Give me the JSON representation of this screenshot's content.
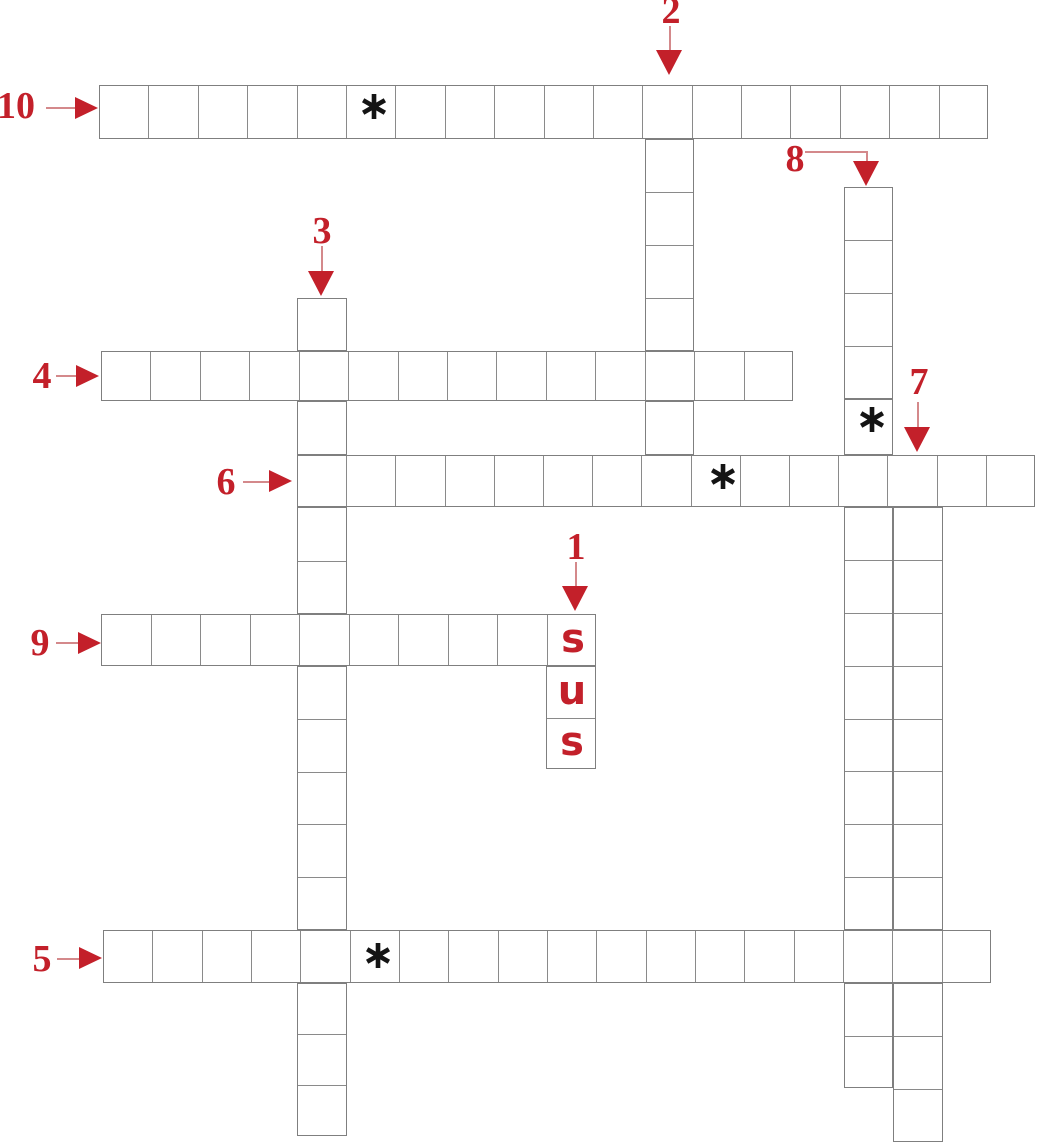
{
  "puzzle": {
    "type": "crossword",
    "colors": {
      "accent_red": "#c3202a",
      "arrow_line": "#d4898b",
      "grid_line": "#7f7f7f",
      "star_black": "#141414",
      "background": "#ffffff"
    },
    "star_char": "∗",
    "prefilled_letters": "sus",
    "clues": [
      {
        "number": "1",
        "direction": "down",
        "length": 3,
        "prefilled": "sus"
      },
      {
        "number": "2",
        "direction": "down",
        "length": 8
      },
      {
        "number": "3",
        "direction": "down",
        "length": 16
      },
      {
        "number": "4",
        "direction": "across",
        "length": 14
      },
      {
        "number": "5",
        "direction": "across",
        "length": 18,
        "star_cell": 6
      },
      {
        "number": "6",
        "direction": "across",
        "length": 15,
        "star_cell": 9
      },
      {
        "number": "7",
        "direction": "down",
        "length": 13
      },
      {
        "number": "8",
        "direction": "down",
        "length": 17,
        "star_cell": 5
      },
      {
        "number": "9",
        "direction": "across",
        "length": 10
      },
      {
        "number": "10",
        "direction": "across",
        "length": 18,
        "star_cell": 6
      }
    ],
    "numbers": [
      {
        "label": "1",
        "x": 576,
        "y": 547,
        "dir": "down",
        "tip": [
          575,
          611
        ],
        "lines": [
          [
            575,
            562,
            575,
            588
          ]
        ]
      },
      {
        "label": "2",
        "x": 671,
        "y": 11,
        "dir": "down",
        "tip": [
          669,
          75
        ],
        "lines": [
          [
            669,
            26,
            669,
            52
          ]
        ]
      },
      {
        "label": "3",
        "x": 322,
        "y": 231,
        "dir": "down",
        "tip": [
          321,
          296
        ],
        "lines": [
          [
            321,
            246,
            321,
            273
          ]
        ]
      },
      {
        "label": "4",
        "x": 42,
        "y": 376,
        "dir": "right",
        "tip": [
          99,
          376
        ],
        "lines": [
          [
            56,
            375,
            78,
            375
          ]
        ]
      },
      {
        "label": "5",
        "x": 42,
        "y": 959,
        "dir": "right",
        "tip": [
          102,
          958
        ],
        "lines": [
          [
            57,
            958,
            81,
            958
          ]
        ]
      },
      {
        "label": "6",
        "x": 226,
        "y": 482,
        "dir": "right",
        "tip": [
          292,
          481
        ],
        "lines": [
          [
            243,
            481,
            270,
            481
          ]
        ]
      },
      {
        "label": "7",
        "x": 919,
        "y": 382,
        "dir": "down",
        "tip": [
          917,
          452
        ],
        "lines": [
          [
            917,
            402,
            917,
            430
          ]
        ]
      },
      {
        "label": "8",
        "x": 795,
        "y": 159,
        "dir": "down",
        "tip": [
          866,
          186
        ],
        "lines": [
          [
            805,
            151,
            866,
            151
          ],
          [
            866,
            151,
            866,
            163
          ]
        ]
      },
      {
        "label": "9",
        "x": 40,
        "y": 643,
        "dir": "right",
        "tip": [
          101,
          643
        ],
        "lines": [
          [
            56,
            642,
            79,
            642
          ]
        ]
      },
      {
        "label": "10",
        "x": 16,
        "y": 106,
        "dir": "right",
        "tip": [
          98,
          108
        ],
        "lines": [
          [
            46,
            107,
            77,
            107
          ]
        ]
      }
    ],
    "segments": [
      {
        "id": "10",
        "dir": "h",
        "x": 99,
        "y": 85,
        "w": 889,
        "h": 54,
        "n": 18
      },
      {
        "id": "4",
        "dir": "h",
        "x": 101,
        "y": 351,
        "w": 692,
        "h": 50,
        "n": 14
      },
      {
        "id": "6",
        "dir": "h",
        "x": 297,
        "y": 455,
        "w": 738,
        "h": 52,
        "n": 15
      },
      {
        "id": "9",
        "dir": "h",
        "x": 101,
        "y": 614,
        "w": 495,
        "h": 52,
        "n": 10
      },
      {
        "id": "5",
        "dir": "h",
        "x": 103,
        "y": 930,
        "w": 888,
        "h": 53,
        "n": 18
      },
      {
        "id": "2a",
        "dir": "v",
        "x": 645,
        "y": 139,
        "w": 49,
        "h": 212,
        "n": 4
      },
      {
        "id": "2b",
        "dir": "v",
        "x": 645,
        "y": 401,
        "w": 49,
        "h": 54,
        "n": 1
      },
      {
        "id": "3a",
        "dir": "v",
        "x": 297,
        "y": 298,
        "w": 50,
        "h": 53,
        "n": 1
      },
      {
        "id": "3b",
        "dir": "v",
        "x": 297,
        "y": 401,
        "w": 50,
        "h": 54,
        "n": 1
      },
      {
        "id": "3c",
        "dir": "v",
        "x": 297,
        "y": 507,
        "w": 50,
        "h": 107,
        "n": 2
      },
      {
        "id": "3d",
        "dir": "v",
        "x": 297,
        "y": 666,
        "w": 50,
        "h": 264,
        "n": 5
      },
      {
        "id": "3e",
        "dir": "v",
        "x": 297,
        "y": 983,
        "w": 50,
        "h": 153,
        "n": 3
      },
      {
        "id": "8a",
        "dir": "v",
        "x": 844,
        "y": 187,
        "w": 49,
        "h": 212,
        "n": 4
      },
      {
        "id": "8b",
        "dir": "v",
        "x": 844,
        "y": 399,
        "w": 49,
        "h": 56,
        "n": 1
      },
      {
        "id": "8c",
        "dir": "v",
        "x": 844,
        "y": 507,
        "w": 49,
        "h": 423,
        "n": 8
      },
      {
        "id": "8d",
        "dir": "v",
        "x": 844,
        "y": 983,
        "w": 49,
        "h": 105,
        "n": 2
      },
      {
        "id": "7a",
        "dir": "v",
        "x": 893,
        "y": 507,
        "w": 50,
        "h": 423,
        "n": 8
      },
      {
        "id": "7b",
        "dir": "v",
        "x": 893,
        "y": 983,
        "w": 50,
        "h": 159,
        "n": 3
      },
      {
        "id": "1",
        "dir": "v",
        "x": 546,
        "y": 666,
        "w": 50,
        "h": 103,
        "n": 2
      }
    ],
    "stars": [
      {
        "x": 374,
        "y": 107,
        "in": "word-10"
      },
      {
        "x": 872,
        "y": 420,
        "in": "word-8"
      },
      {
        "x": 723,
        "y": 477,
        "in": "word-6"
      },
      {
        "x": 378,
        "y": 956,
        "in": "word-5"
      }
    ],
    "letters": [
      {
        "ch": "s",
        "x": 573,
        "y": 640
      },
      {
        "ch": "u",
        "x": 572,
        "y": 692
      },
      {
        "ch": "s",
        "x": 572,
        "y": 743
      }
    ]
  }
}
